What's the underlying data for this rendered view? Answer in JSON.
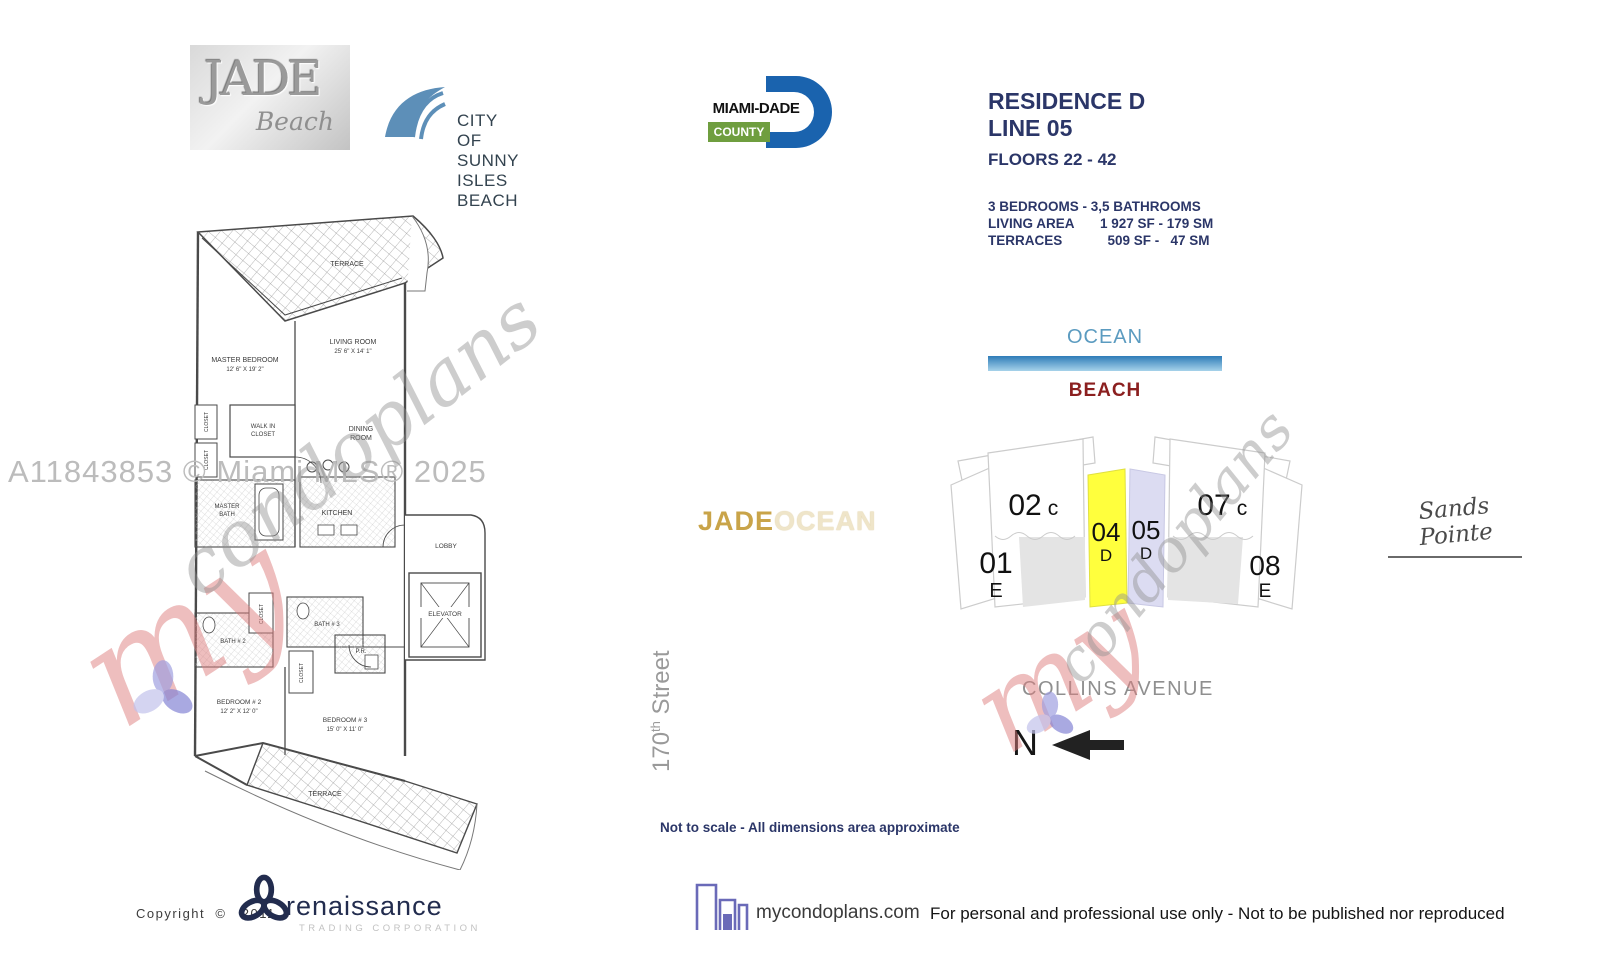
{
  "header": {
    "jade": {
      "title": "JADE",
      "subtitle": "Beach"
    },
    "city": {
      "label": "CITY OF SUNNY ISLES BEACH"
    },
    "county": {
      "name": "MIAMI-DADE",
      "sub": "COUNTY"
    }
  },
  "residence": {
    "line1": "RESIDENCE D",
    "line2": "LINE 05",
    "floors": "FLOORS 22 - 42",
    "bed_bath": "3 BEDROOMS - 3,5 BATHROOMS",
    "living_label": "LIVING AREA",
    "living_value": "1 927 SF - 179 SM",
    "terraces_label": "TERRACES",
    "terraces_value": "  509 SF -   47 SM"
  },
  "diagram": {
    "ocean": "OCEAN",
    "beach": "BEACH",
    "collins": "COLLINS AVENUE",
    "north": "N",
    "street_num": "170",
    "street_sup": "th",
    "street_word": " Street",
    "colors": {
      "ocean_text": "#5b9bc0",
      "beach_text": "#8b1f1f",
      "bar_top": "#2e7cb8",
      "bar_bottom": "#a6d2ea"
    }
  },
  "keyplan": {
    "units": [
      {
        "num": "01",
        "letter": "E"
      },
      {
        "num": "02",
        "letter": "c"
      },
      {
        "num": "04",
        "letter": "D",
        "color": "#ffff3d"
      },
      {
        "num": "05",
        "letter": "D",
        "color": "#dcdcf2"
      },
      {
        "num": "07",
        "letter": "c"
      },
      {
        "num": "08",
        "letter": "E"
      }
    ]
  },
  "floorplan": {
    "terrace_top": "TERRACE",
    "master_bedroom": "MASTER BEDROOM",
    "master_bedroom_dims": "12' 6\" X 19' 2\"",
    "living_room": "LIVING ROOM",
    "living_room_dims": "25' 6\" X 14' 1\"",
    "walkin_l1": "WALK IN",
    "walkin_l2": "CLOSET",
    "dining_l1": "DINING",
    "dining_l2": "ROOM",
    "closet_a": "CLOSET",
    "closet_b": "CLOSET",
    "closet_mid": "CLOSET",
    "closet_low": "CLOSET",
    "master_bath_l1": "MASTER",
    "master_bath_l2": "BATH",
    "kitchen": "KITCHEN",
    "lobby": "LOBBY",
    "elevator": "ELEVATOR",
    "bath2": "BATH # 2",
    "bath3": "BATH # 3",
    "pr": "P.R.",
    "bedroom2": "BEDROOM # 2",
    "bedroom2_dims": "12' 2\" X 12' 0\"",
    "bedroom3": "BEDROOM # 3",
    "bedroom3_dims": "15' 0\"  X 11' 0\"",
    "terrace_bottom": "TERRACE"
  },
  "watermarks": {
    "mls": "A11843853 © Miami MLS® 2025",
    "brand_prefix": "my",
    "brand_rest": "condoplans",
    "jade": "JADE",
    "ocean": "OCEAN",
    "sands": "Sands Pointe"
  },
  "note": "Not to scale - All dimensions area approximate",
  "footer": {
    "copyright": "Copyright  ©   2011",
    "renaissance": "renaissance",
    "renaissance_sub": "TRADING CORPORATION",
    "site": "mycondoplans.com",
    "disclaimer": "For personal and professional use only - Not to be published nor reproduced"
  }
}
